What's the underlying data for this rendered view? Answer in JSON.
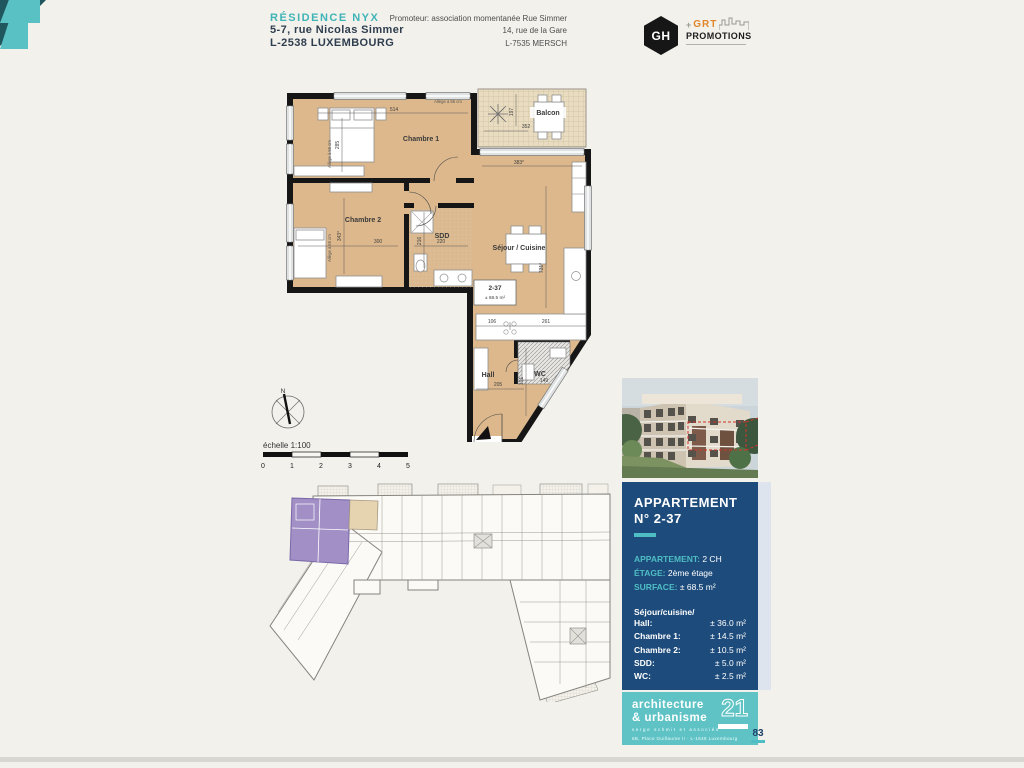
{
  "header": {
    "residence": "RÉSIDENCE NYX",
    "address1": "5-7, rue Nicolas Simmer",
    "address2": "L-2538 LUXEMBOURG",
    "promoter1": "Promoteur: association momentanée Rue Simmer",
    "promoter2": "14, rue de la Gare",
    "promoter3": "L-7535 MERSCH",
    "logo_gh": "GH",
    "logo_grt": "GRT",
    "logo_grt_sub": "PROMOTIONS"
  },
  "plan": {
    "rooms": {
      "chambre1": "Chambre 1",
      "chambre2": "Chambre 2",
      "sdd": "SDD",
      "sejour": "Séjour / Cuisine",
      "hall": "Hall",
      "wc": "WC",
      "balcon": "Balcon"
    },
    "unit": {
      "number": "2-37",
      "area": "± 68.5 m²"
    },
    "allege": "Allège à 55 cm",
    "dims": {
      "d514": "514",
      "d285": "285",
      "d300": "300",
      "d343": "343°",
      "d220": "220",
      "d216": "216",
      "d383": "383°",
      "d352": "352",
      "d197": "197",
      "d731": "731°",
      "d106": "106",
      "d261": "261",
      "d205": "205",
      "d191": "191",
      "d149": "149"
    }
  },
  "compass": {
    "north": "N"
  },
  "scale": {
    "label": "échelle 1:100",
    "ticks": [
      "0",
      "1",
      "2",
      "3",
      "4",
      "5"
    ]
  },
  "info": {
    "title1": "APPARTEMENT",
    "title2": "N° 2-37",
    "spec_labels": [
      "APPARTEMENT:",
      "ÉTAGE:",
      "SURFACE:"
    ],
    "spec_values": [
      "2 CH",
      "2ème étage",
      "± 68.5 m²"
    ],
    "rooms_header": "Séjour/cuisine/",
    "rooms": [
      {
        "label": "Hall:",
        "value": "± 36.0 m²"
      },
      {
        "label": "Chambre 1:",
        "value": "± 14.5 m²"
      },
      {
        "label": "Chambre 2:",
        "value": "± 10.5 m²"
      },
      {
        "label": "SDD:",
        "value": "± 5.0 m²"
      },
      {
        "label": "WC:",
        "value": "± 2.5 m²"
      },
      {
        "label": "Balcon:",
        "value": "± 7.0 m²"
      }
    ]
  },
  "agency": {
    "line1": "architecture",
    "line2": "& urbanisme",
    "number": "21",
    "partners": "serge schmit et associés",
    "address": "6B, Place Guillaume II · L-1648 Luxembourg"
  },
  "page": {
    "number": "83"
  }
}
